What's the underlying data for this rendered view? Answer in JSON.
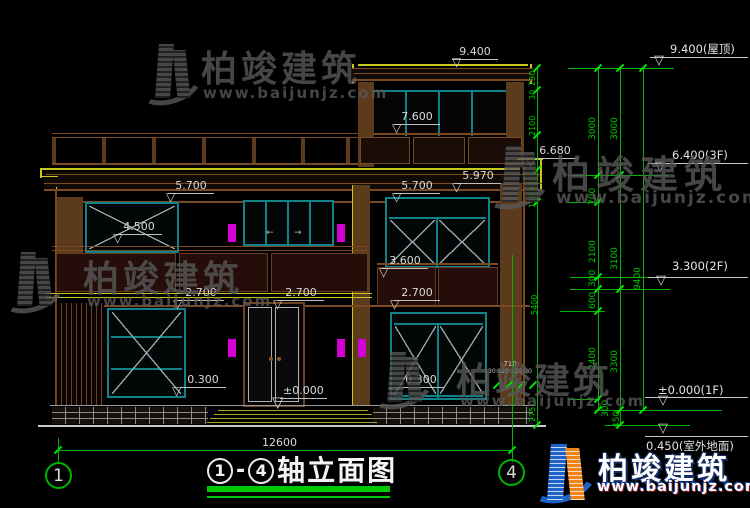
{
  "watermarks": {
    "brand": "柏竣建筑",
    "url": "www.baijunjz.com"
  },
  "title": {
    "axis_start": "1",
    "separator": "-",
    "axis_end": "4",
    "label": "轴立面图"
  },
  "axes": {
    "left_bubble": "1",
    "right_bubble": "4"
  },
  "dims": {
    "overall_width": "12600",
    "chain_a": [
      "3000",
      "700",
      "2100",
      "300",
      "600",
      "2400",
      "300"
    ],
    "chain_b": [
      "3000",
      "3100",
      "3300",
      "450"
    ],
    "chain_c": [
      "9400"
    ],
    "side_chain": [
      "230",
      "30",
      "2100",
      "30",
      "120",
      "5400",
      "275"
    ],
    "cluster_top": "710",
    "cluster_bottom": "30 120 120 30"
  },
  "elevation_labels": {
    "roof": "9.400",
    "tower_sill": "7.600",
    "eave_top": "6.680",
    "eave_bottom": "5.970",
    "lintel2f_left": "5.700",
    "lintel2f_right": "5.700",
    "parapet": "4.500",
    "spandrel_top": "3.600",
    "sill2f_left": "2.700",
    "sill2f_center": "2.700",
    "sill2f_right": "2.700",
    "sill1f_left": "0.300",
    "sill1f_right": "0.300",
    "floor1": "±0.000"
  },
  "level_flags": [
    "9.400(屋顶)",
    "6.400(3F)",
    "3.300(2F)",
    "±0.000(1F)",
    "0.450(室外地面)"
  ],
  "icons": {
    "triangle_down": "▽",
    "arrow_left": "←",
    "arrow_right": "→"
  },
  "colors": {
    "background": "#000000",
    "cad_brown": "#7c4a22",
    "cad_yellow": "#c8c81e",
    "cad_teal": "#12828a",
    "dim_green": "#00b400",
    "lamp_magenta": "#d400d4",
    "text_white": "#d9d9d9",
    "watermark_grey": "#585858",
    "logo_blue": "#1e62c8",
    "logo_orange": "#f08418"
  }
}
